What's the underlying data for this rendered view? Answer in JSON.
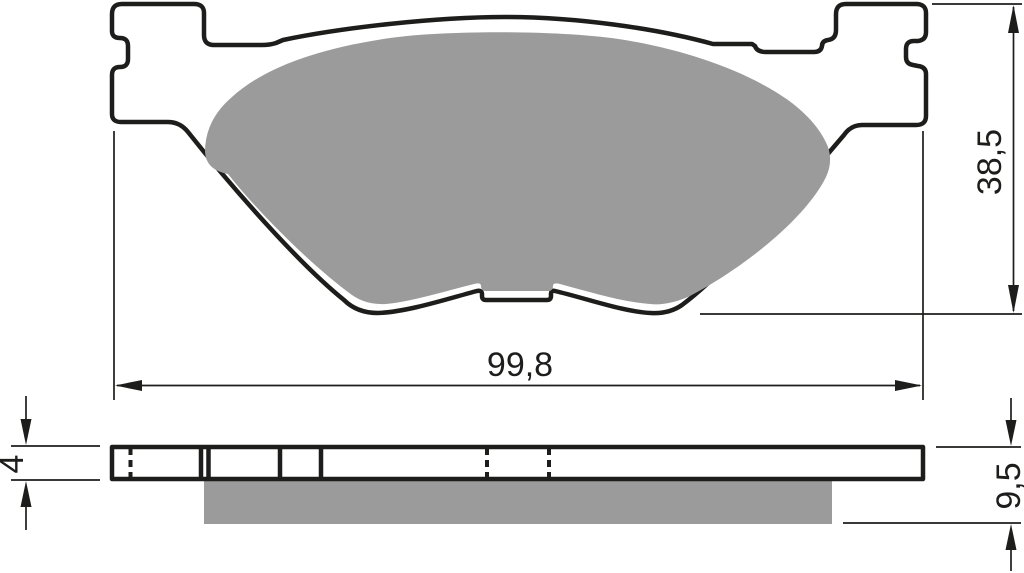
{
  "dimensions": {
    "width": {
      "label": "99,8"
    },
    "height": {
      "label": "38,5"
    },
    "backplate_thickness": {
      "label": "4"
    },
    "total_thickness": {
      "label": "9,5"
    }
  },
  "colors": {
    "line": "#1d1d1b",
    "friction_material": "#9b9b9b",
    "background": "#ffffff"
  }
}
